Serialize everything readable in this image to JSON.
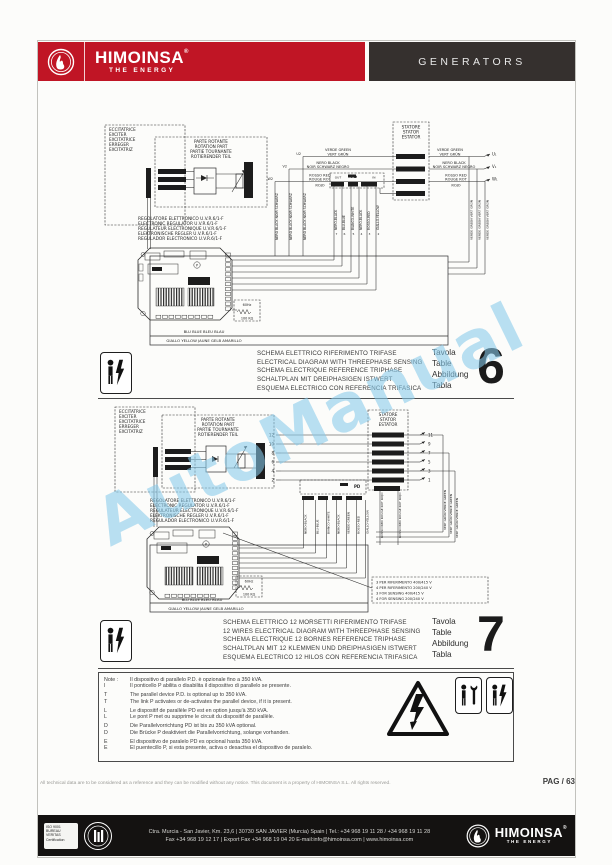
{
  "header": {
    "brand": "HIMOINSA",
    "reg": "®",
    "brand_sub": "THE ENERGY",
    "section": "GENERATORS"
  },
  "watermark": "AutoManual",
  "d1": {
    "exciter": [
      "ECCITATRICE",
      "EXCITER",
      "EXCITATRICE",
      "ERREGER",
      "EXCITATRIZ"
    ],
    "rotating": [
      "PARTE ROTANTE",
      "ROTATION PART",
      "PARTIE TOURNANTE",
      "ROTIERENDER TEIL"
    ],
    "stator": [
      "STATORE",
      "STATOR",
      "ESTATOR"
    ],
    "regulator": [
      "REGOLATORE ELETTRONICO U.V.R.6/1-F",
      "ELECTRONIC REGULATOR U.V.R.6/1-F",
      "REGULATEUR ELECTRONIQUE U.V.R.6/1-F",
      "ELEKTRONISCHE REGLER U.V.R.6/1-F",
      "REGULADOR ELECTRONICO U.V.R.6/1-F"
    ],
    "green_a": "VERDE GREEN",
    "green_b": "VERT GRÜN",
    "black_a": "NERO BLACK",
    "black_b": "NOIR SCHWARZ NEGRO",
    "red_a": "ROSSO RED",
    "red_b": "ROUGE ROT",
    "red_c": "ROJO",
    "u1": "U₁",
    "v1": "V₁",
    "w1": "W₁",
    "u2": "U2",
    "v2": "V2",
    "w2": "W2",
    "pd": "PD",
    "out": "OUT",
    "in": "IN",
    "p": "P",
    "pd_wires": [
      "NERO-BLACK",
      "BLU-BLUE",
      "BIANCO-WHITE",
      "NERO-BLACK",
      "ROSSO-RED",
      "GIALLO-YELLOW"
    ],
    "pd_terms": [
      "7",
      "6",
      "5",
      "4",
      "3",
      "2"
    ],
    "vert_black": "NERO BLACK NOIR SCHWARZ",
    "vert_green": "VERDE GREEN VERT GRÜN",
    "freq": "60Hz",
    "res": "100 KΩ",
    "blu": "BLU BLUE BLEU BLAU",
    "giallo": "GIALLO YELLOW JAUNE GELB AMARILLO"
  },
  "d2": {
    "exciter": [
      "ECCITATRICE",
      "EXCITER",
      "EXCITATRICE",
      "ERREGER",
      "EXCITATRIZ"
    ],
    "rotating": [
      "PARTE ROTANTE",
      "ROTATION PART",
      "PARTIE TOURNANTE",
      "ROTIERENDER TEIL"
    ],
    "stator": [
      "STATORE",
      "STATOR",
      "ESTATOR"
    ],
    "regulator": [
      "REGOLATORE ELETTRONICO U.V.R.6/1-F",
      "ELECTRONIC REGULATOR U.V.R.6/1-F",
      "REGULATEUR ELECTRONIQUE U.V.R.6/1-F",
      "ELEKTRONISCHE REGLER U.V.R.6/1-F",
      "REGULADOR ELECTRONICO U.V.R.6/1-F"
    ],
    "left_terms": [
      "12",
      "10",
      "8",
      "6",
      "4",
      "2"
    ],
    "right_terms": [
      "11",
      "9",
      "7",
      "5",
      "3",
      "1"
    ],
    "pd": "PD",
    "p": "P",
    "pd_wires": [
      "NERO-BLACK",
      "BLU-BLUE",
      "BIANCO-WHITE",
      "NERO-BLACK",
      "VERDE-GREEN",
      "ROSSO-RED",
      "GIALLO-YELLOW"
    ],
    "vert_red": "ROSSO RED ROUGE ROT ROJO",
    "vert_green": "VERT GRÜN VERDE GREEN",
    "ref_box": [
      "3 PER RIFERIMENTO 400/415 V",
      "4 PER RIFERIMENTO 200/240 V",
      "3 FOR SENSING 400/415 V",
      "4 FOR SENSING 200/240 V"
    ],
    "freq": "60Hz",
    "res": "100 KΩ",
    "blu": "BLU BLUE BLEU BLAU",
    "giallo": "GIALLO YELLOW JAUNE GELB AMARILLO"
  },
  "captions": {
    "t6": {
      "lines": [
        "SCHEMA ELETTRICO RIFERIMENTO TRIFASE",
        "ELECTRICAL DIAGRAM WITH THREEPHASE SENSING",
        "SCHEMA ELECTRIQUE REFERENCE TRIPHASE",
        "SCHALTPLAN MIT DREIPHASIGEN ISTWERT",
        "ESQUEMA ELECTRICO CON REFERENCIA TRIFASICA"
      ],
      "tavola": [
        "Tavola",
        "Table",
        "Abbildung",
        "Tabla"
      ],
      "number": "6"
    },
    "t7": {
      "lines": [
        "SCHEMA ELETTRICO 12 MORSETTI RIFERIMENTO TRIFASE",
        "12 WIRES ELECTRICAL DIAGRAM WITH THREEPHASE SENSING",
        "SCHEMA ELECTRIQUE 12 BORNES REFERENCE TRIPHASE",
        "SCHALTPLAN MIT 12 KLEMMEN UND DREIPHASIGEN ISTWERT",
        "ESQUEMA ELECTRICO 12 HILOS CON REFERENCIA TRIFASICA"
      ],
      "tavola": [
        "Tavola",
        "Table",
        "Abbildung",
        "Tabla"
      ],
      "number": "7"
    }
  },
  "notes": {
    "rows": [
      {
        "m": "Note :",
        "t": "Il dispositivo di parallelo P.D. è opzionale fino a 350 kVA."
      },
      {
        "m": "I",
        "t": "Il ponticello P abilita o disabilita il dispositivo di parallelo se presente."
      },
      {
        "m": "T",
        "t": "The parallel device P.D. is optional up to 350 kVA."
      },
      {
        "m": "T",
        "t": "The link P activates or de-activates the parallel device, if it is present."
      },
      {
        "m": "L",
        "t": "Le dispositif de parallèle PD est en option jusqu'à 350 kVA."
      },
      {
        "m": "L",
        "t": "Le pont P met ou supprime le circuit du dispositif de parallèle."
      },
      {
        "m": "D",
        "t": "Die Parallelvorrichtung PD ist bis zu 350 kVA optional."
      },
      {
        "m": "D",
        "t": "Die Brücke P deaktiviert die Parallelvorrichtung, solange vorhanden."
      },
      {
        "m": "E",
        "t": "El dispositivo de paralelo PD es opcional hasta 350 kVA."
      },
      {
        "m": "E",
        "t": "El puentecillo P, si esta presente, activa o desactiva el dispositivo de paralelo."
      }
    ]
  },
  "smallprint": {
    "disclaimer": "All technical data are to be considered as a reference and they can be modified without any notice. This document is a property of HIMOINSA S.L. All rights reserved.",
    "page": "PAG / 63"
  },
  "footer": {
    "cert_line1": "ISO 9001",
    "cert_line2": "BUREAU VERITAS",
    "cert_line3": "Certification",
    "address_line1": "Ctra. Murcia - San Javier, Km. 23,6 | 30730 SAN JAVIER (Murcia) Spain | Tel.: +34 968 19 11 28 / +34 968 19 11 28",
    "address_line2": "Fax +34 968 19 12 17 | Export Fax +34 968 19 04 20 E-mail:info@himoinsa.com | www.himoinsa.com",
    "brand": "HIMOINSA",
    "reg": "®",
    "brand_sub": "THE ENERGY"
  }
}
